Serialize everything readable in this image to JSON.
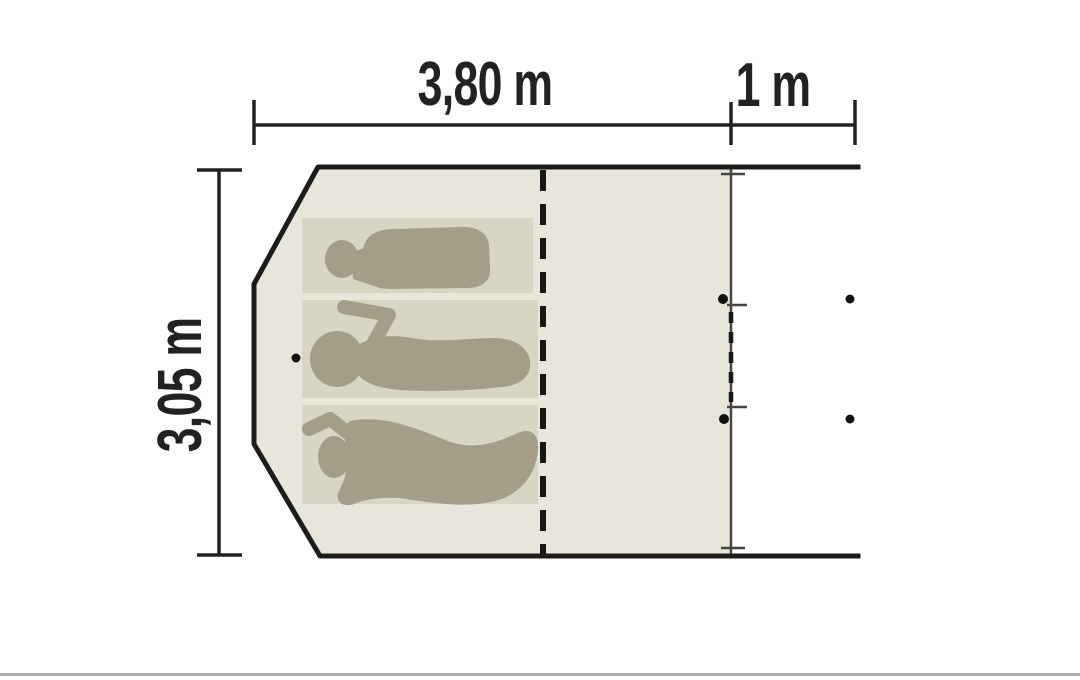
{
  "diagram": {
    "kind": "tent-floor-plan",
    "occupants": 3,
    "dimensions": {
      "width_label": "3,80 m",
      "porch_label": "1 m",
      "depth_label": "3,05 m"
    },
    "colors": {
      "outline": "#1c1c1a",
      "dimension": "#222220",
      "tent_fill": "#e8e6da",
      "mat_fill": "#d8d5c5",
      "figure_fill": "#a49e88",
      "thin_line": "#46453f",
      "dash_line": "#171715",
      "dot": "#121210",
      "bottom_rule": "#aeaeae"
    }
  }
}
